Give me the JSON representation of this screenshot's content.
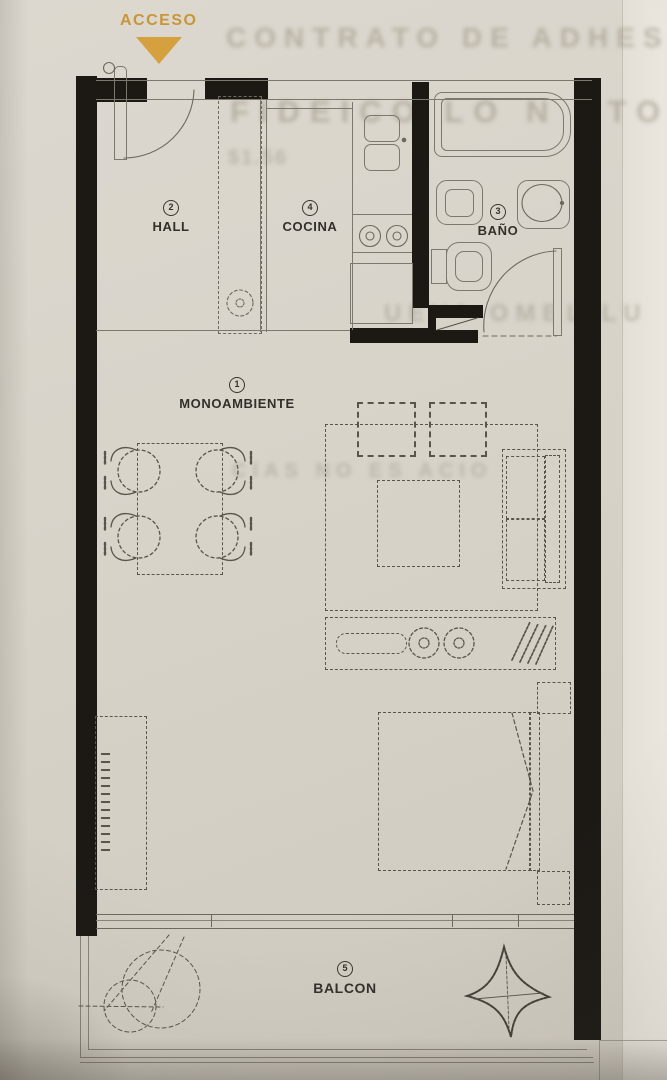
{
  "acceso_label": "ACCESO",
  "rooms": {
    "monoambiente": {
      "number": "1",
      "name": "MONOAMBIENTE"
    },
    "hall": {
      "number": "2",
      "name": "HALL"
    },
    "bano": {
      "number": "3",
      "name": "BAÑO"
    },
    "cocina": {
      "number": "4",
      "name": "COCINA"
    },
    "balcon": {
      "number": "5",
      "name": "BALCON"
    }
  },
  "watermarks": {
    "line1": "CONTRATO DE ADHES",
    "line2": "FIDEICO LO N ETO",
    "line3": "$1.56",
    "line4": "UEVA OMBL LU",
    "line5": "CIAS NO ES ACIO"
  },
  "colors": {
    "accent": "#d5a03e",
    "wall": "#1c1915",
    "paper": "#d7d3c9",
    "thin_line": "#7d786d",
    "furniture_line": "#5a554b"
  }
}
